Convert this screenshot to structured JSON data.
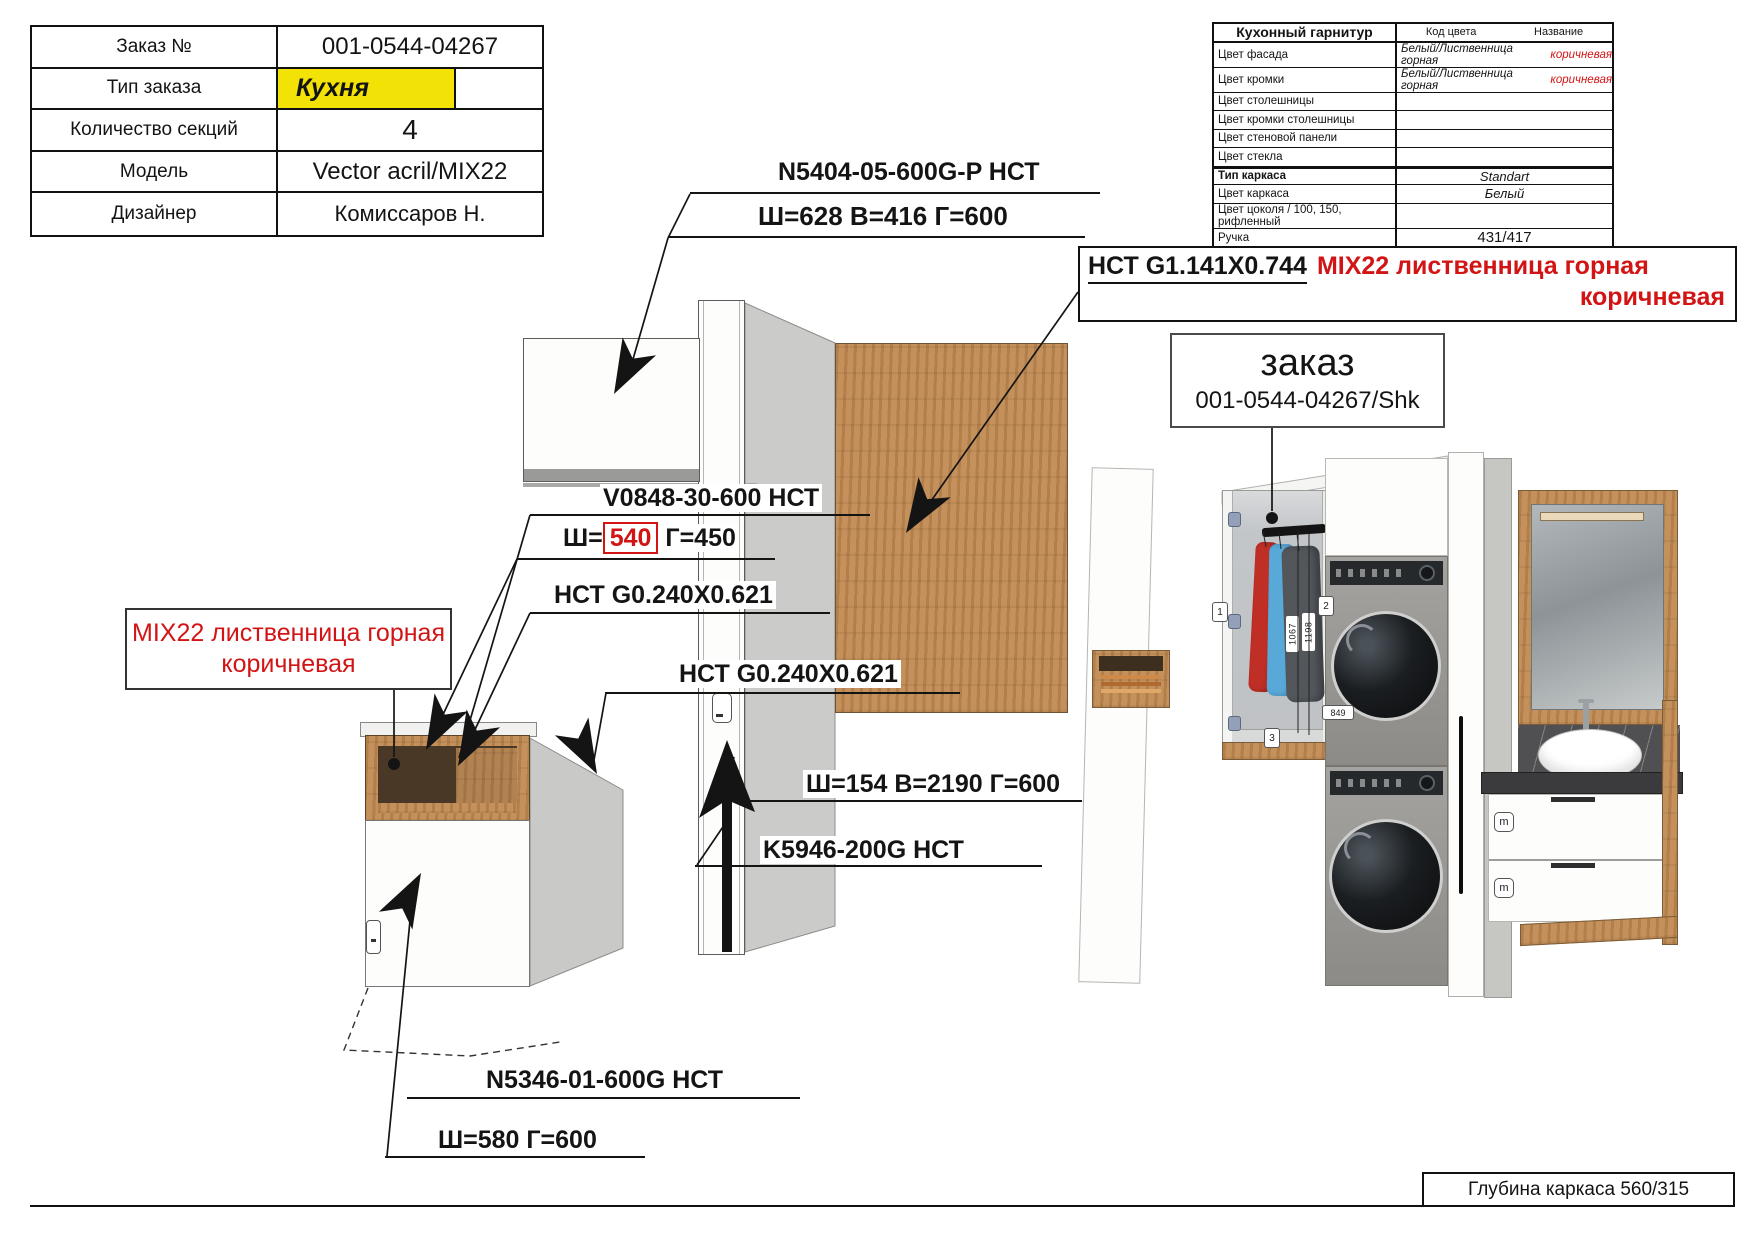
{
  "order_table": {
    "rows": [
      {
        "label": "Заказ №",
        "value": "001-0544-04267"
      },
      {
        "label": "Тип заказа",
        "value": "Кухня"
      },
      {
        "label": "Количество секций",
        "value": "4"
      },
      {
        "label": "Модель",
        "value": "Vector acril/MIX22"
      },
      {
        "label": "Дизайнер",
        "value": "Комиссаров Н."
      }
    ]
  },
  "spec_table": {
    "title": "Кухонный гарнитур",
    "col_code": "Код цвета",
    "col_name": "Название",
    "rows": [
      {
        "label": "Цвет фасада",
        "value": "Белый/Лиственница горная",
        "value_red": "коричневая"
      },
      {
        "label": "Цвет кромки",
        "value": "Белый/Лиственница горная",
        "value_red": "коричневая"
      },
      {
        "label": "Цвет столешницы",
        "value": "",
        "value_red": ""
      },
      {
        "label": "Цвет кромки столешницы",
        "value": "",
        "value_red": ""
      },
      {
        "label": "Цвет стеновой панели",
        "value": "",
        "value_red": ""
      },
      {
        "label": "Цвет стекла",
        "value": "",
        "value_red": ""
      },
      {
        "label": "Тип каркаса",
        "value": "Standart",
        "value_red": ""
      },
      {
        "label": "Цвет каркаса",
        "value": "Белый",
        "value_red": ""
      },
      {
        "label": "Цвет цоколя / 100, 150, рифленный",
        "value": "",
        "value_red": ""
      },
      {
        "label": "Ручка",
        "value": "431/417",
        "value_red": ""
      }
    ]
  },
  "callouts": {
    "upper_cabinet_code": "N5404-05-600G-P НСТ",
    "upper_cabinet_dims": "Ш=628 В=416 Г=600",
    "panel_code_black": "НСТ G1.141X0.744",
    "panel_code_red_1": "MIX22 лиственница горная",
    "panel_code_red_2": "коричневая",
    "order_ref_title": "заказ",
    "order_ref_number": "001-0544-04267/Shk",
    "shelf_code": "V0848-30-600 НСТ",
    "shelf_w_prefix": "Ш=",
    "shelf_w_value": "540",
    "shelf_d": "Г=450",
    "mix22_line_1": "MIX22 лиственница горная",
    "mix22_line_2": "коричневая",
    "side_panel_code_1": "НСТ G0.240X0.621",
    "side_panel_code_2": "НСТ G0.240X0.621",
    "tall_panel_dims": "Ш=154 В=2190 Г=600",
    "plinth_code": "K5946-200G НСТ",
    "base_cabinet_code": "N5346-01-600G НСТ",
    "base_cabinet_dims": "Ш=580 Г=600"
  },
  "render_labels": {
    "marker_1": "1",
    "marker_2": "2",
    "marker_3": "3",
    "dim_1067": "1067",
    "dim_1198": "1198",
    "dim_849": "849",
    "drawer_m_top": "m",
    "drawer_m_bottom": "m"
  },
  "footer": {
    "depth_note": "Глубина каркаса 560/315"
  },
  "colors": {
    "highlight_yellow": "#F2E205",
    "accent_red": "#D21414",
    "wood": "#C08A52"
  }
}
